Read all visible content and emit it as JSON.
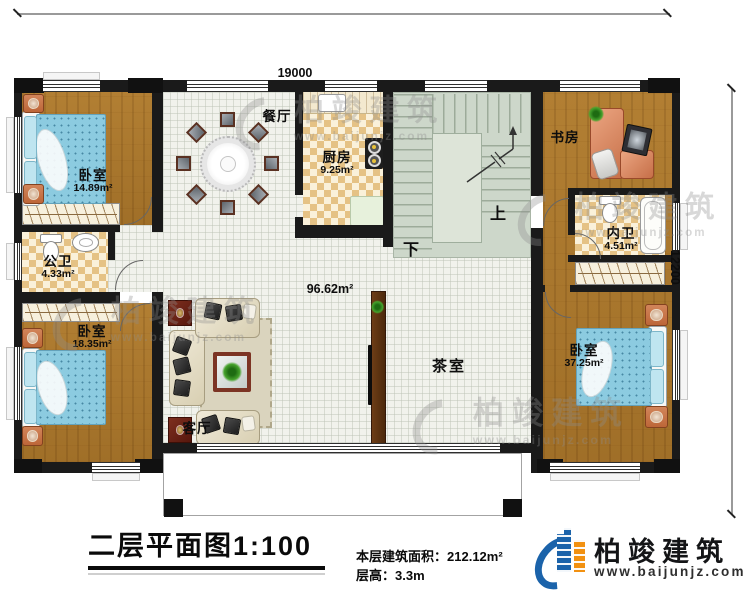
{
  "dimensions": {
    "top_width": "19000",
    "right_height": "12200"
  },
  "rooms": {
    "bedroom_top_left": {
      "name": "卧室",
      "area": "14.89m²"
    },
    "public_bath": {
      "name": "公卫",
      "area": "4.33m²"
    },
    "bedroom_bottom_left": {
      "name": "卧室",
      "area": "18.35m²"
    },
    "dining": {
      "name": "餐厅"
    },
    "kitchen": {
      "name": "厨房",
      "area": "9.25m²"
    },
    "living": {
      "name": "客厅"
    },
    "hall": {
      "area": "96.62m²"
    },
    "tea_room": {
      "name": "茶室"
    },
    "study": {
      "name": "书房"
    },
    "inner_bath": {
      "name": "内卫",
      "area": "4.51m²"
    },
    "bedroom_right": {
      "name": "卧室",
      "area": "37.25m²"
    }
  },
  "stairs": {
    "up_label": "上",
    "down_label": "下"
  },
  "title_block": {
    "title": "二层平面图1:100",
    "floor_area_label": "本层建筑面积：",
    "floor_area_value": "212.12m²",
    "floor_height_label": "层高：",
    "floor_height_value": "3.3m"
  },
  "brand": {
    "name": "柏竣建筑",
    "url": "www.baijunjz.com"
  },
  "watermark": {
    "name": "柏竣建筑",
    "url": "www.baijunjz.com"
  },
  "colors": {
    "wall": "#1a1a1a",
    "wood": "#a9772e",
    "accent_blue": "#1b63aa",
    "accent_orange": "#f29111",
    "bed": "#8ccbe0",
    "stair_tile": "#cdd7ca"
  }
}
